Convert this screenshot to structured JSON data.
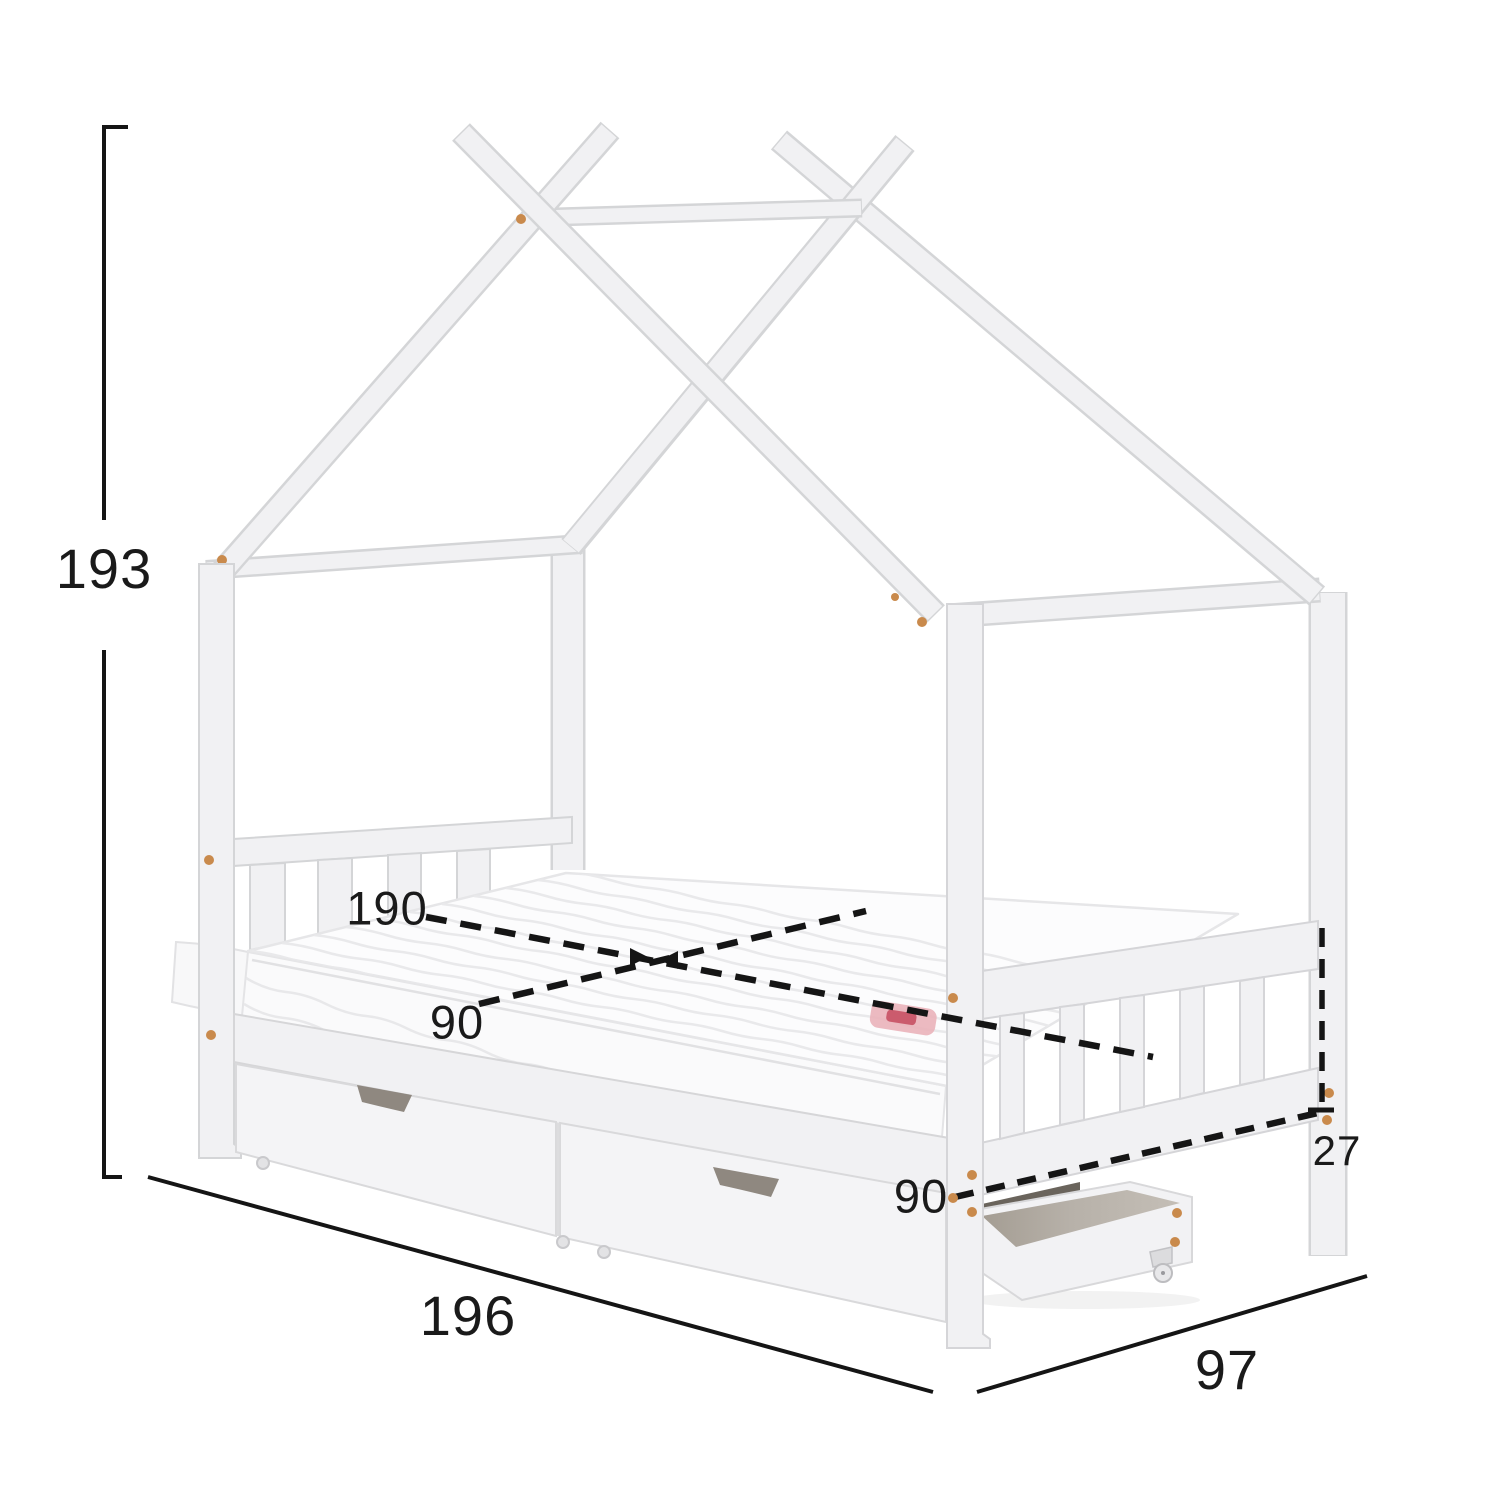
{
  "diagram": {
    "kind": "furniture-dimension-diagram",
    "subject": "white house-frame (tipi) kids bed with two storage drawers, pull-out castor drawer and quilted mattress",
    "labels": {
      "height": "193",
      "length": "196",
      "depth": "97",
      "mattress_length": "190",
      "mattress_width": "90",
      "base_width": "90",
      "side_rail_height": "27"
    },
    "colors": {
      "background": "#ffffff",
      "frame_fill": "#f1f1f3",
      "frame_edge": "#d4d5d7",
      "dimension_line": "#151515",
      "screw_dot": "#c98a4c",
      "drawer_interior": "#b5afa7",
      "handle_notch": "#8f8880",
      "mattress_tag_pink": "#eab3ba",
      "mattress_tag_red": "#c64a5e"
    }
  }
}
